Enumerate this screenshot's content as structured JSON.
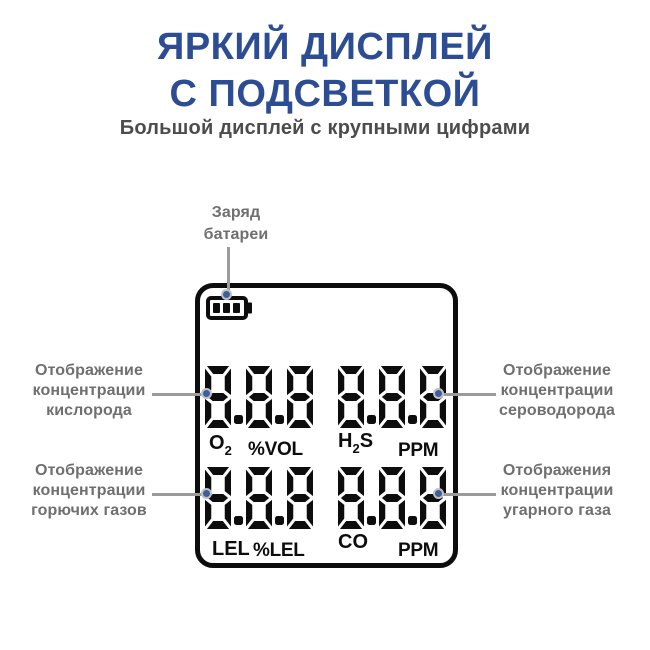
{
  "header": {
    "title_line1": "ЯРКИЙ ДИСПЛЕЙ",
    "title_line2": "С ПОДСВЕТКОЙ",
    "subtitle": "Большой дисплей с крупными цифрами"
  },
  "colors": {
    "title": "#2C4D93",
    "subtitle": "#4C4C4C",
    "callout_text": "#6F6F6F",
    "callout_line": "#9B9B9B",
    "callout_dot": "#3C5E9F",
    "display_ink": "#0D0D0D"
  },
  "callouts": {
    "battery": {
      "lines": [
        "Заряд",
        "батареи"
      ]
    },
    "oxygen": {
      "lines": [
        "Отображение",
        "концентрации",
        "кислорода"
      ]
    },
    "combustible": {
      "lines": [
        "Отображение",
        "концентрации",
        "горючих газов"
      ]
    },
    "hydrogen_sulfide": {
      "lines": [
        "Отображение",
        "концентрации",
        "сероводорода"
      ]
    },
    "carbon_monoxide": {
      "lines": [
        "Отображения",
        "концентрации",
        "угарного газа"
      ]
    }
  },
  "display": {
    "battery_bars": 3,
    "quadrants": {
      "o2": {
        "value": "8.8.8",
        "gas_main": "O",
        "gas_sub": "2",
        "gas_tail": "",
        "unit": "%VOL"
      },
      "h2s": {
        "value": "8.8.8",
        "gas_main": "H",
        "gas_sub": "2",
        "gas_tail": "S",
        "unit": "PPM"
      },
      "lel": {
        "value": "8.8.8",
        "gas_main": "LEL",
        "gas_sub": "",
        "gas_tail": "",
        "unit": "%LEL"
      },
      "co": {
        "value": "8.8.8",
        "gas_main": "CO",
        "gas_sub": "",
        "gas_tail": "",
        "unit": "PPM"
      }
    }
  }
}
